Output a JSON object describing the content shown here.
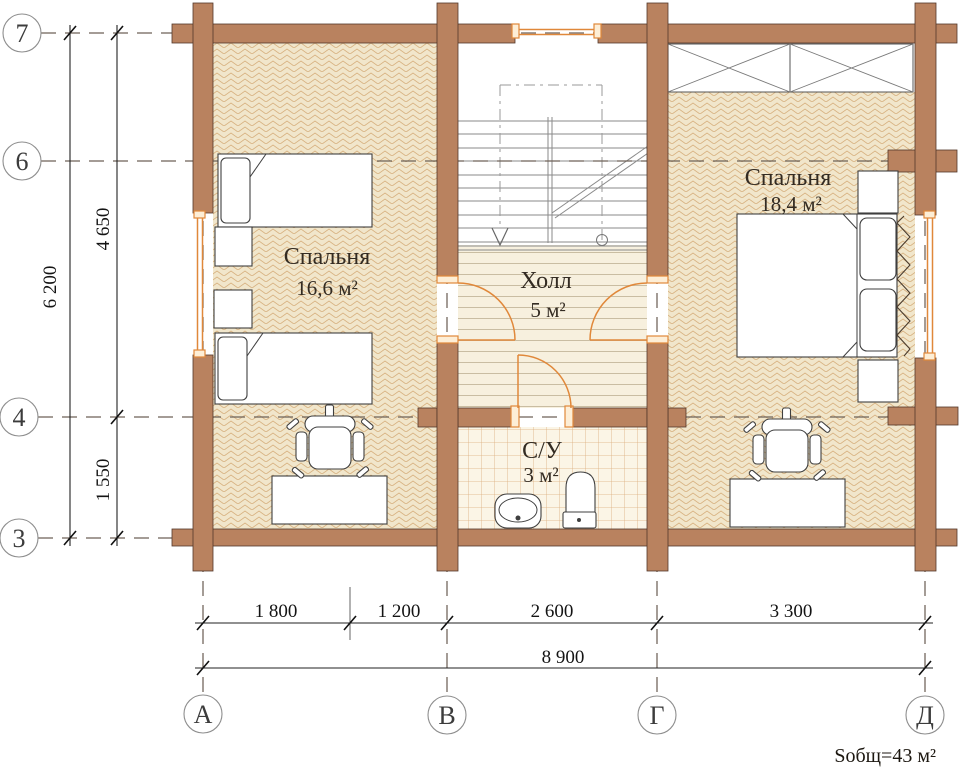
{
  "rooms": [
    {
      "name": "Спальня",
      "area": "16,6 м²"
    },
    {
      "name": "Холл",
      "area": "5 м²"
    },
    {
      "name": "С/У",
      "area": "3 м²"
    },
    {
      "name": "Спальня",
      "area": "18,4 м²"
    }
  ],
  "axes": {
    "row_labels": [
      "7",
      "6",
      "4",
      "3"
    ],
    "col_labels": [
      "А",
      "В",
      "Г",
      "Д"
    ]
  },
  "dimensions": {
    "col_segments": [
      "1 800",
      "1 200",
      "2 600",
      "3 300"
    ],
    "col_total": "8 900",
    "row_segments": [
      "4 650",
      "1 550"
    ],
    "row_total": "6 200"
  },
  "summary": {
    "total_area": "Sобщ=43 м²"
  },
  "colors": {
    "wall": "#b9825f",
    "window_door": "#e0883a",
    "floor_base": "#f1e6cb",
    "dimension_ink": "#141414"
  }
}
